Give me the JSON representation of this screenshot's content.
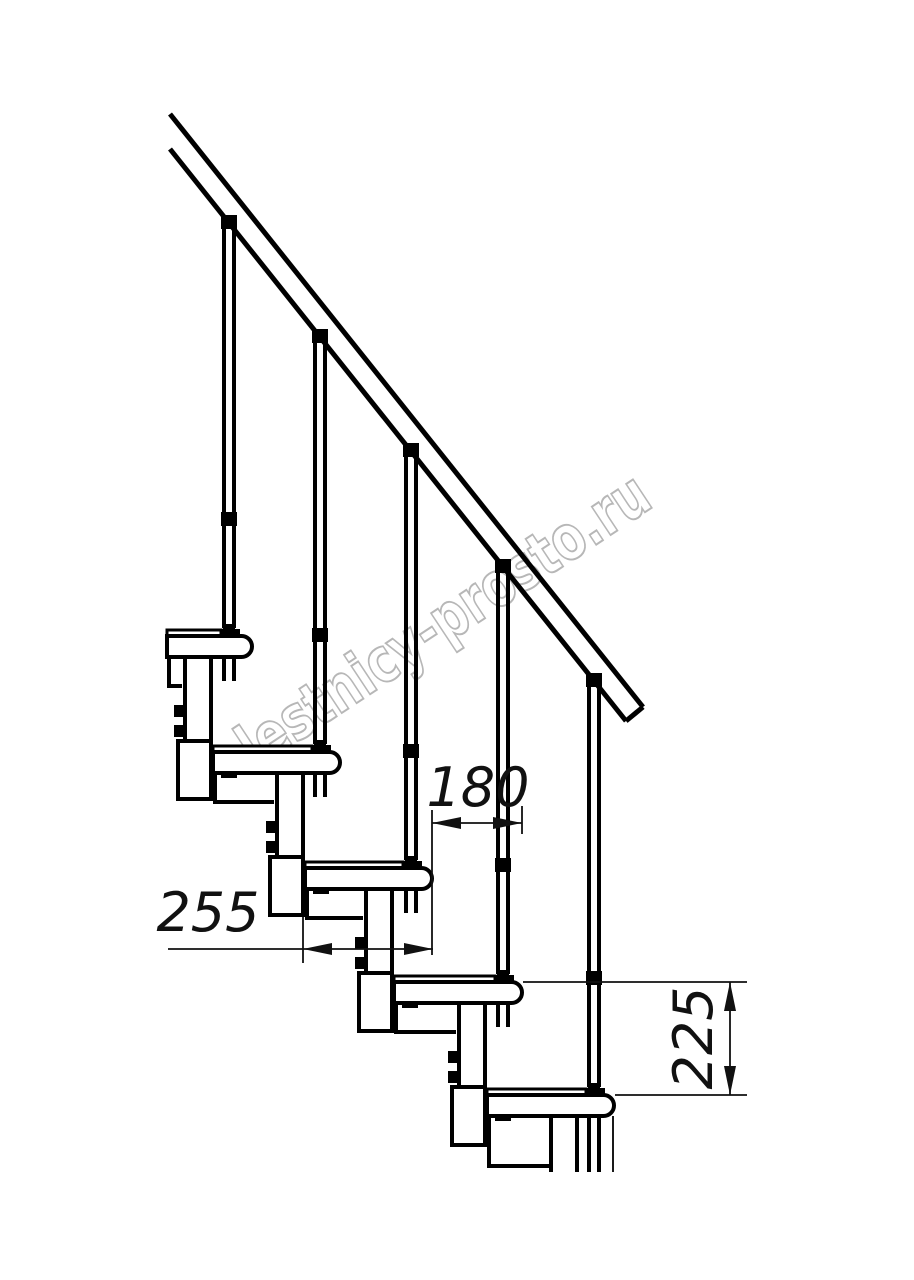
{
  "drawing": {
    "title": "modular-staircase-side-view",
    "watermark": "lestnicy-prosto.ru",
    "colors": {
      "line": "#000000",
      "background": "#ffffff",
      "watermark_stroke": "#ababab"
    },
    "dimensions": {
      "step_run": {
        "value": "180",
        "unit": "mm",
        "orientation": "horizontal"
      },
      "tread_depth": {
        "value": "255",
        "unit": "mm",
        "orientation": "horizontal"
      },
      "step_rise": {
        "value": "225",
        "unit": "mm",
        "orientation": "vertical"
      }
    },
    "counts": {
      "treads": 5,
      "balusters": 5,
      "support_modules": 5
    }
  }
}
